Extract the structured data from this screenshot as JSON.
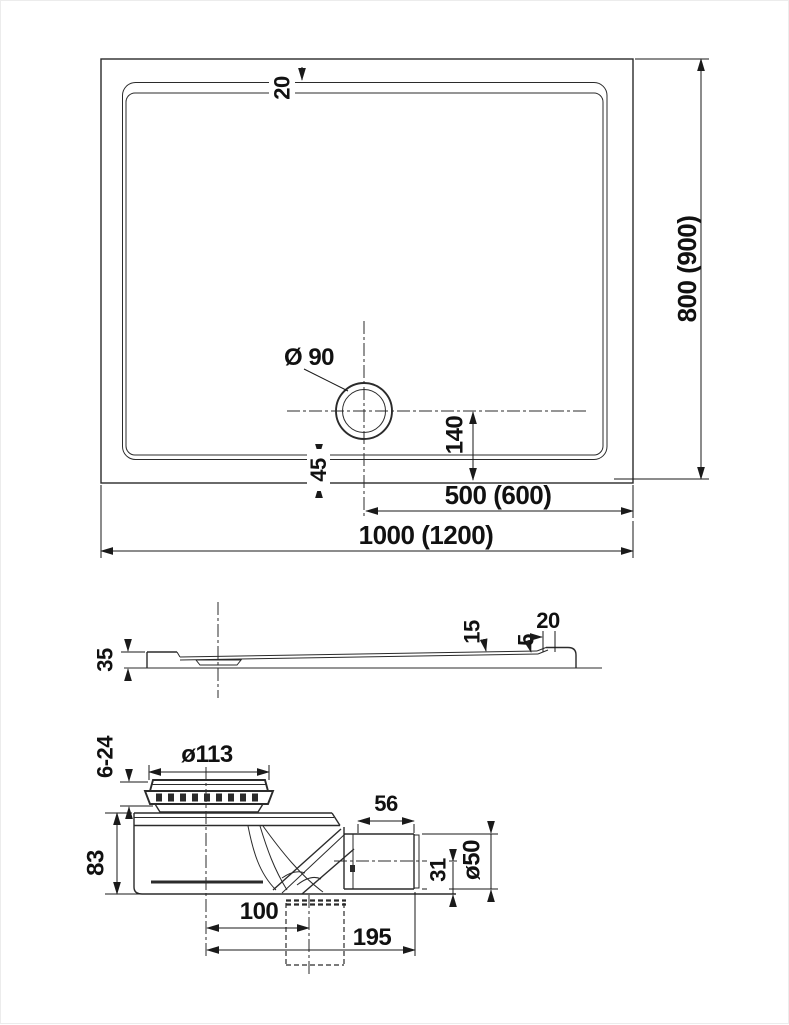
{
  "top_view": {
    "rim_top": "20",
    "drain_diameter": "Ø 90",
    "drain_offset": "140",
    "rim_bottom": "45",
    "drain_from_right": "500 (600)",
    "overall_width": "1000 (1200)",
    "overall_depth": "800 (900)"
  },
  "side_view": {
    "height": "35",
    "basin_depth": "15",
    "lip": "5",
    "rim": "20"
  },
  "drain_detail": {
    "cap_diameter": "ø113",
    "cap_height": "6-24",
    "body_height": "83",
    "outlet_length": "56",
    "outlet_diameter": "ø50",
    "outlet_center_height": "31",
    "hole_offset": "100",
    "overall_length": "195"
  }
}
